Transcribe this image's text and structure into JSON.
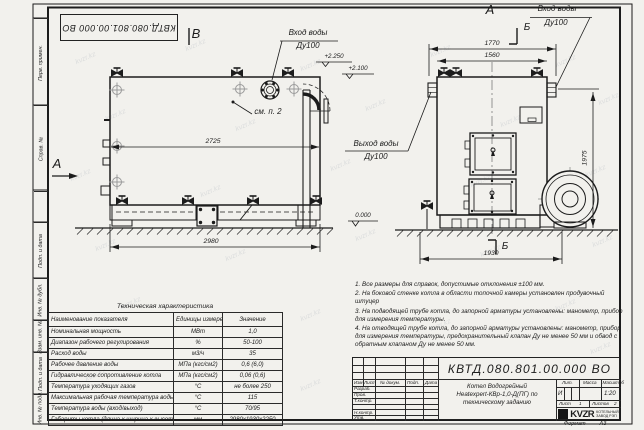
{
  "watermark": {
    "text": "kvzr.kz",
    "positions": [
      [
        75,
        55
      ],
      [
        185,
        42
      ],
      [
        300,
        62
      ],
      [
        430,
        48
      ],
      [
        555,
        58
      ],
      [
        105,
        112
      ],
      [
        235,
        122
      ],
      [
        365,
        102
      ],
      [
        500,
        118
      ],
      [
        598,
        96
      ],
      [
        70,
        172
      ],
      [
        200,
        188
      ],
      [
        330,
        162
      ],
      [
        470,
        178
      ],
      [
        585,
        168
      ],
      [
        95,
        242
      ],
      [
        225,
        252
      ],
      [
        355,
        232
      ],
      [
        480,
        248
      ],
      [
        592,
        238
      ],
      [
        120,
        300
      ],
      [
        300,
        312
      ],
      [
        430,
        322
      ],
      [
        555,
        302
      ],
      [
        85,
        372
      ],
      [
        300,
        382
      ],
      [
        590,
        345
      ]
    ]
  },
  "sheet": {
    "stamp_number": "КВТД.080.801.00.000 ВО",
    "format_label": "Формат",
    "format_value": "А3"
  },
  "margin_labels": {
    "c1": "Перв. примен.",
    "c2": "Справ. №",
    "c3": "Подп. и дата",
    "c4": "Инв. № дубл.",
    "c5": "Взам. инв. №",
    "c6": "Подп. и дата",
    "c7": "Инв. № подл."
  },
  "side_view": {
    "view_label": "В",
    "section_label": "А",
    "inlet_l1": "Вход воды",
    "inlet_l2": "Ду100",
    "see_note": "см. п. 2",
    "elev_top": "+2.250",
    "elev_mid": "+2.100",
    "elev_zero": "0.000",
    "dim_inner": "2725",
    "dim_outer": "2980"
  },
  "front_view": {
    "view_label": "А",
    "section_top": "Б",
    "section_bottom": "Б",
    "inlet_l1": "Вход воды",
    "inlet_l2": "Ду100",
    "outlet_l1": "Выход воды",
    "outlet_l2": "Ду100",
    "dim_outer": "1770",
    "dim_inner": "1560",
    "dim_height": "1975",
    "dim_base": "1930"
  },
  "notes": {
    "n1": "1. Все размеры для справок, допустимые отклонения ±100 мм.",
    "n2": "2. На боковой стенке котла в области топочной камеры установлен продувочный штуцер",
    "n3": "3. На подводящей трубе котла, до запорной арматуры установлены: манометр, прибор для измерения температуры.",
    "n4": "4. На отводящей трубе котла, до запорной арматуры установлены: манометр, прибор для измерения температуры, предохранительный клапан Ду не менее 50 мм и обвод с обратным клапаном Ду не менее 50 мм."
  },
  "tech_table": {
    "title": "Техническая характеристика",
    "col_name": "Наименование показателя",
    "col_unit": "Единицы измерения",
    "col_value": "Значение",
    "rows": [
      {
        "n": "Номинальная мощность",
        "u": "МВт",
        "v": "1,0"
      },
      {
        "n": "Диапазон рабочего регулирования",
        "u": "%",
        "v": "50-100"
      },
      {
        "n": "Расход воды",
        "u": "м3/ч",
        "v": "35"
      },
      {
        "n": "Рабочее давление воды",
        "u": "МПа (кгс/см2)",
        "v": "0,6 (6,0)"
      },
      {
        "n": "Гидравлическое сопротивление котла",
        "u": "МПа (кгс/см2)",
        "v": "0,06 (0,6)"
      },
      {
        "n": "Температура уходящих газов",
        "u": "°С",
        "v": "не более 250"
      },
      {
        "n": "Максимальная рабочая температура воды",
        "u": "°С",
        "v": "115"
      },
      {
        "n": "Температура воды (вход/выход)",
        "u": "°С",
        "v": "70/95"
      },
      {
        "n": "Габариты котла (длина х ширина х высота)",
        "u": "мм",
        "v": "2980х1930х2250"
      }
    ]
  },
  "title_block": {
    "doc_number": "КВТД.080.801.00.000 ВО",
    "product_l1": "Котел Водогрейный",
    "product_l2": "Heatexpert-КВр-1,0-Д(ПГ) по",
    "product_l3": "техническому заданию",
    "rev": {
      "izm": "Изм",
      "list": "Лист",
      "doc": "№ докум.",
      "podp": "Подп.",
      "data": "Дата"
    },
    "signs": {
      "s1": "Разраб.",
      "s2": "Пров.",
      "s3": "Т.контр.",
      "s4": "Н.контр.",
      "s5": "Утв."
    },
    "lit_label": "Лит.",
    "lit_value": "И",
    "mass_label": "Масса",
    "scale_label": "Масштаб",
    "scale_value": "1:20",
    "sheet_label": "Лист",
    "sheet_value": "1",
    "sheets_label": "Листов",
    "sheets_value": "2",
    "logo_text": "KVZR",
    "company_l1": "КОТЕЛЬНЫЙ",
    "company_l2": "ЗАВОД РЭП"
  }
}
